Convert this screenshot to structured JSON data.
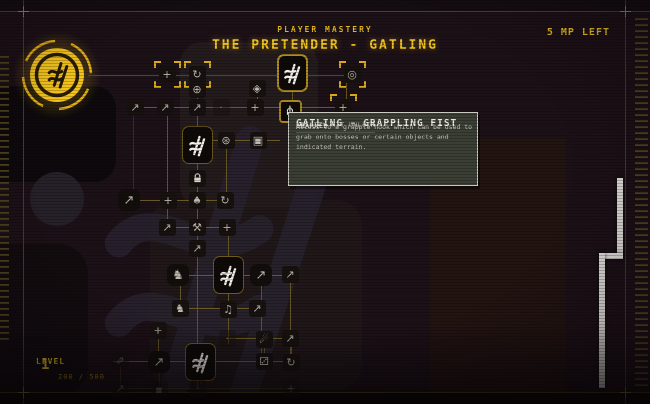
{
  "header": {
    "kicker": "PLAYER MASTERY",
    "title": "THE PRETENDER - GATLING",
    "mp_left": "5 MP LEFT"
  },
  "footer": {
    "level_label": "LEVEL",
    "level_value": "1",
    "xp_progress": "200 / 500"
  },
  "tooltip": {
    "title": "GATLING - GRAPPLING FIST",
    "type": "ABILITY KIT UNLOCK",
    "description": "Access to a grapple hook which can be used to grab onto bosses or certain objects and indicated terrain.",
    "status": "LEARNED"
  },
  "colors": {
    "accent_yellow": "#f0c41f",
    "connector_olive": "#6e5d24",
    "tooltip_bg": "#3a3e35",
    "selected_border": "#b08c1e"
  },
  "tree": {
    "nodes": [
      {
        "name": "skill-node-plus-a1",
        "x": 167,
        "y": 74,
        "kind": "corners",
        "glyph": "plus"
      },
      {
        "name": "skill-node-spin-a2",
        "x": 197,
        "y": 74,
        "kind": "corners",
        "glyph": "spin"
      },
      {
        "name": "skill-node-gatling-top",
        "x": 292,
        "y": 73,
        "kind": "big",
        "sel": true,
        "glyph": "gatling"
      },
      {
        "name": "skill-node-turret",
        "x": 352,
        "y": 74,
        "kind": "corners",
        "glyph": "target"
      },
      {
        "name": "skill-node-orb",
        "x": 197,
        "y": 89,
        "glyph": "orb"
      },
      {
        "name": "skill-node-gem",
        "x": 257,
        "y": 88,
        "glyph": "gem"
      },
      {
        "name": "skill-node-arrow-b1",
        "x": 135,
        "y": 107,
        "glyph": "arrow"
      },
      {
        "name": "skill-node-arrow-b2",
        "x": 165,
        "y": 107,
        "glyph": "arrow"
      },
      {
        "name": "skill-node-arrow-b3",
        "x": 197,
        "y": 107,
        "glyph": "arrow"
      },
      {
        "name": "skill-node-empty-b4",
        "x": 221,
        "y": 107,
        "glyph": "dot",
        "dim": true
      },
      {
        "name": "skill-node-plus-b5",
        "x": 255,
        "y": 107,
        "glyph": "plus"
      },
      {
        "name": "skill-node-grappling-fist",
        "x": 290,
        "y": 111,
        "kind": "med",
        "glyph": "grapple"
      },
      {
        "name": "skill-node-plus-b7",
        "x": 343,
        "y": 107,
        "kind": "corners",
        "glyph": "plus"
      },
      {
        "name": "skill-node-gatling-mid",
        "x": 197,
        "y": 145,
        "kind": "big",
        "glyph": "gatling"
      },
      {
        "name": "skill-node-burst",
        "x": 226,
        "y": 140,
        "glyph": "burst"
      },
      {
        "name": "skill-node-panel",
        "x": 258,
        "y": 140,
        "glyph": "panel"
      },
      {
        "name": "skill-node-lock",
        "x": 197,
        "y": 178,
        "glyph": "lock"
      },
      {
        "name": "skill-node-arrow-d1",
        "x": 129,
        "y": 200,
        "kind": "boxy",
        "glyph": "arrow"
      },
      {
        "name": "skill-node-plus-d2",
        "x": 168,
        "y": 200,
        "glyph": "plus"
      },
      {
        "name": "skill-node-spade",
        "x": 197,
        "y": 200,
        "glyph": "spade"
      },
      {
        "name": "skill-node-spin-d4",
        "x": 225,
        "y": 200,
        "glyph": "spin"
      },
      {
        "name": "skill-node-arrow-e1",
        "x": 167,
        "y": 227,
        "glyph": "arrow"
      },
      {
        "name": "skill-node-hammer",
        "x": 197,
        "y": 227,
        "glyph": "hammer"
      },
      {
        "name": "skill-node-plus-e3",
        "x": 227,
        "y": 227,
        "glyph": "plus"
      },
      {
        "name": "skill-node-arrow-e4",
        "x": 197,
        "y": 248,
        "glyph": "arrow"
      },
      {
        "name": "skill-node-knight-f1",
        "x": 178,
        "y": 275,
        "kind": "boxy",
        "glyph": "knight"
      },
      {
        "name": "skill-node-gatling-low",
        "x": 228,
        "y": 275,
        "kind": "big",
        "glyph": "gatling"
      },
      {
        "name": "skill-node-arrow-f3",
        "x": 261,
        "y": 275,
        "kind": "boxy",
        "glyph": "arrow"
      },
      {
        "name": "skill-node-arrow-f4",
        "x": 290,
        "y": 274,
        "glyph": "arrow"
      },
      {
        "name": "skill-node-knight-g1",
        "x": 180,
        "y": 308,
        "glyph": "knight"
      },
      {
        "name": "skill-node-note",
        "x": 228,
        "y": 309,
        "glyph": "note"
      },
      {
        "name": "skill-node-arrow-g3",
        "x": 257,
        "y": 308,
        "glyph": "arrow"
      },
      {
        "name": "skill-node-plus-h0",
        "x": 158,
        "y": 330,
        "glyph": "plus"
      },
      {
        "name": "skill-node-empty-h1",
        "x": 227,
        "y": 338,
        "glyph": "dot",
        "dim": true
      },
      {
        "name": "skill-node-comet",
        "x": 264,
        "y": 339,
        "glyph": "comet"
      },
      {
        "name": "skill-node-arrow-h3",
        "x": 290,
        "y": 338,
        "glyph": "arrow"
      },
      {
        "name": "skill-node-dblarrow",
        "x": 120,
        "y": 360,
        "glyph": "dblarrow",
        "dim": true
      },
      {
        "name": "skill-node-arrow-i1",
        "x": 159,
        "y": 362,
        "kind": "boxy",
        "glyph": "arrow"
      },
      {
        "name": "skill-node-gatling-bottom",
        "x": 200,
        "y": 362,
        "kind": "big",
        "glyph": "gatling"
      },
      {
        "name": "skill-node-die",
        "x": 264,
        "y": 361,
        "glyph": "die"
      },
      {
        "name": "skill-node-spin-i4",
        "x": 291,
        "y": 362,
        "glyph": "spin"
      },
      {
        "name": "skill-node-arrow-j1",
        "x": 120,
        "y": 388,
        "glyph": "arrow",
        "dim": true
      },
      {
        "name": "skill-node-sq-j2",
        "x": 159,
        "y": 389,
        "glyph": "sq",
        "dim": true
      },
      {
        "name": "skill-node-dot-j3",
        "x": 198,
        "y": 388,
        "glyph": "dot",
        "dim": true
      },
      {
        "name": "skill-node-plus-j4",
        "x": 291,
        "y": 388,
        "glyph": "plus",
        "dim": true
      }
    ],
    "connectors": [
      {
        "x1": 88,
        "y1": 75,
        "x2": 352,
        "y2": 75
      },
      {
        "x1": 135,
        "y1": 107,
        "x2": 343,
        "y2": 107
      },
      {
        "x1": 197,
        "y1": 140,
        "x2": 280,
        "y2": 140
      },
      {
        "x1": 129,
        "y1": 200,
        "x2": 227,
        "y2": 200
      },
      {
        "x1": 167,
        "y1": 227,
        "x2": 227,
        "y2": 227
      },
      {
        "x1": 178,
        "y1": 275,
        "x2": 290,
        "y2": 275
      },
      {
        "x1": 180,
        "y1": 308,
        "x2": 257,
        "y2": 308
      },
      {
        "x1": 227,
        "y1": 338,
        "x2": 290,
        "y2": 338
      },
      {
        "x1": 113,
        "y1": 361,
        "x2": 291,
        "y2": 361
      },
      {
        "x1": 120,
        "y1": 388,
        "x2": 291,
        "y2": 388,
        "dim": true
      },
      {
        "x1": 197,
        "y1": 74,
        "x2": 197,
        "y2": 388
      },
      {
        "x1": 292,
        "y1": 92,
        "x2": 292,
        "y2": 100
      },
      {
        "x1": 346,
        "y1": 80,
        "x2": 346,
        "y2": 102
      },
      {
        "x1": 257,
        "y1": 94,
        "x2": 257,
        "y2": 101
      },
      {
        "x1": 226,
        "y1": 146,
        "x2": 226,
        "y2": 196
      },
      {
        "x1": 167,
        "y1": 113,
        "x2": 167,
        "y2": 221
      },
      {
        "x1": 133,
        "y1": 113,
        "x2": 133,
        "y2": 192,
        "dim": true
      },
      {
        "x1": 228,
        "y1": 233,
        "x2": 228,
        "y2": 344
      },
      {
        "x1": 261,
        "y1": 281,
        "x2": 261,
        "y2": 354
      },
      {
        "x1": 290,
        "y1": 280,
        "x2": 290,
        "y2": 356
      },
      {
        "x1": 180,
        "y1": 281,
        "x2": 180,
        "y2": 302
      },
      {
        "x1": 158,
        "y1": 336,
        "x2": 158,
        "y2": 354
      },
      {
        "x1": 264,
        "y1": 345,
        "x2": 264,
        "y2": 355
      },
      {
        "x1": 291,
        "y1": 344,
        "x2": 291,
        "y2": 356
      },
      {
        "x1": 200,
        "y1": 378,
        "x2": 200,
        "y2": 384,
        "dim": true
      },
      {
        "x1": 120,
        "y1": 366,
        "x2": 120,
        "y2": 384,
        "dim": true
      },
      {
        "x1": 159,
        "y1": 368,
        "x2": 159,
        "y2": 386,
        "dim": true
      }
    ]
  }
}
